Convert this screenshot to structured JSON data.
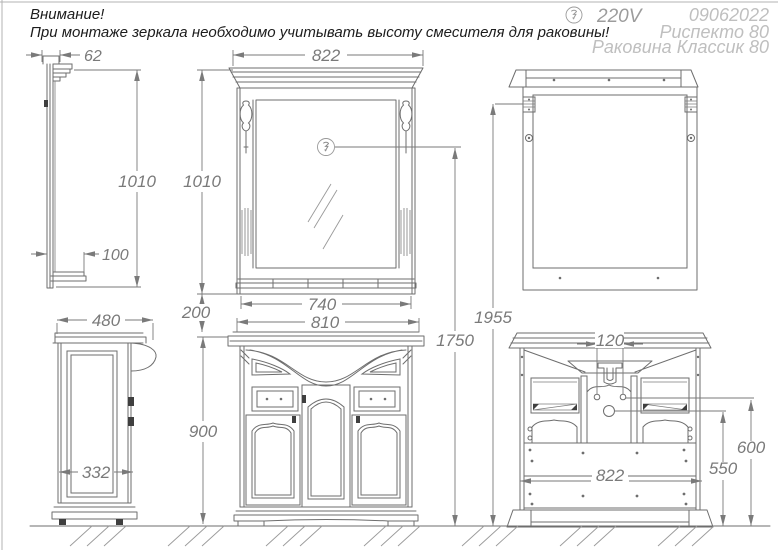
{
  "warning": {
    "line1": "Внимание!",
    "line2": "При монтаже зеркала необходимо учитывать высоту смесителя для раковины!"
  },
  "header": {
    "voltage": "220V",
    "date": "09062022",
    "model": "Риспекто 80",
    "basin_model": "Раковина Классик 80"
  },
  "dims": {
    "mirror_side_width": "62",
    "mirror_side_height": "1010",
    "mirror_shelf_depth": "100",
    "mirror_width": "822",
    "mirror_height": "1010",
    "mirror_shelf_width": "740",
    "mirror_to_cabinet_gap": "200",
    "cabinet_top_width": "810",
    "outlet_height": "1750",
    "mount_height": "1955",
    "cabinet_depth": "480",
    "cabinet_side_panel_width": "332",
    "cabinet_height": "900",
    "pipe_hole_spacing": "120",
    "cabinet_back_width": "822",
    "pipe_hole_height": "600",
    "drain_hole_height": "550"
  },
  "colors": {
    "line": "#6e6e6e",
    "dimension": "#7a7a7a",
    "muted_label": "#bfbfbf",
    "dark_accent": "#3f3f3f",
    "note_text": "#1c1c1c"
  }
}
